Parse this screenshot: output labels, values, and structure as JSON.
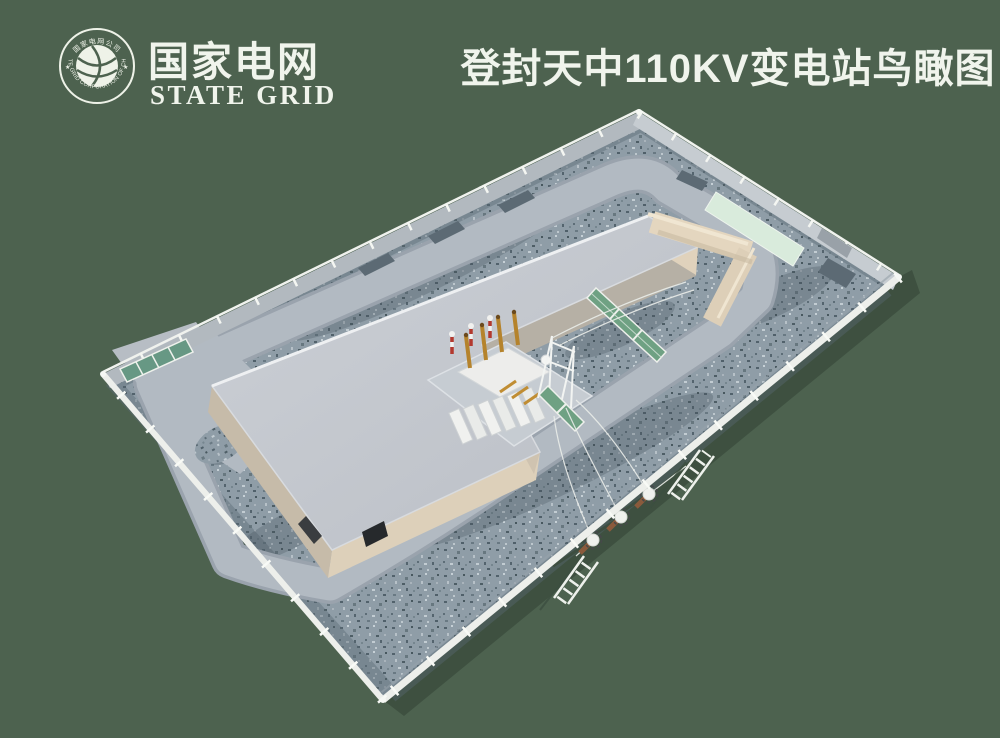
{
  "page": {
    "width": 1000,
    "height": 738,
    "background_color": "#4d624f"
  },
  "branding": {
    "name_zh": "国家电网",
    "name_en": "STATE GRID",
    "emblem": {
      "top_text": "国家电网公司",
      "bottom_text": "STATE GRID CORPORATION OF CHINA",
      "star": "★"
    }
  },
  "header": {
    "title": "登封天中110KV变电站鸟瞰图"
  },
  "scene": {
    "type": "3d-aerial-rendering",
    "subject": "Bird's-eye view rendering of Dengfeng Tianzhong 110KV substation",
    "components": [
      "perimeter-wall",
      "entrance-gate",
      "gate-apron",
      "ring-road",
      "gravel-yard",
      "main-building",
      "building-door",
      "fire-wall",
      "transformer-pad",
      "main-transformer",
      "transformer-radiators",
      "transformer-bushings",
      "surge-arresters",
      "gantry-frame",
      "safety-mesh-fence",
      "mint-parking-pad",
      "equipment-pads",
      "terminal-poles",
      "h-frame-towers",
      "overhead-lines",
      "site-shadow"
    ],
    "palette": {
      "background_green": "#4d624f",
      "shadow_green": "#3e5040",
      "gravel_base": "#8f9da7",
      "gravel_dark": "#5a6a74",
      "road_gray": "#b2bac2",
      "roof_gray": "#c4c8ce",
      "wall_beige": "#ddd0ba",
      "wall_beige_shade": "#c6bba9",
      "firewall_beige": "#e4d6bf",
      "fence_panel_gray": "#b2b9bf",
      "wall_white": "#edefeb",
      "mint_pad": "#d9ebdc",
      "gate_teal": "#679884",
      "mesh_fence_green": "#6fa183",
      "arrester_red": "#b3392e",
      "bushing_gold": "#b5832c",
      "pole_brown": "#8a5a3c",
      "transformer_white": "#f0f1ef",
      "logo_white": "#f0f4ec"
    }
  }
}
